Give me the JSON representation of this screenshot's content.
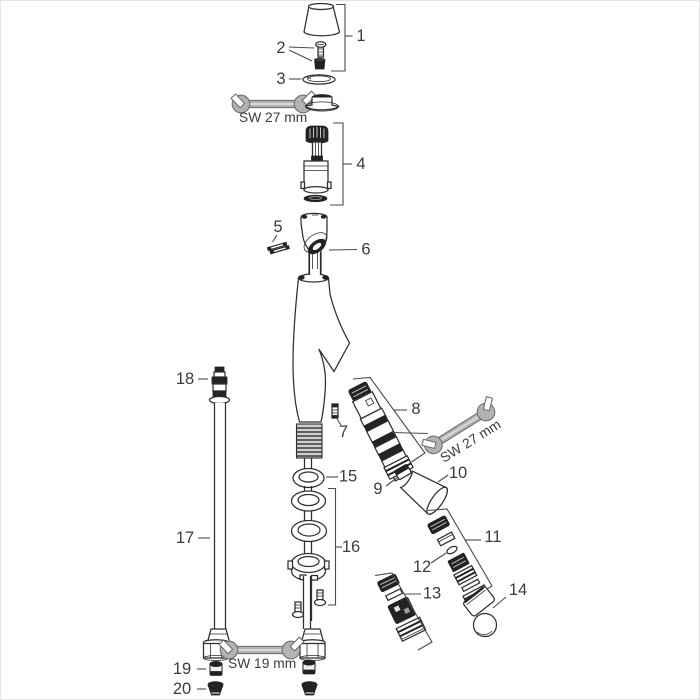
{
  "diagram": {
    "type": "exploded-parts-diagram",
    "subject": "single-lever-basin-mixer-faucet",
    "background": "#ffffff",
    "line_color": "#2f2f2f",
    "label_color": "#3c3c3c",
    "tool_color": "#b3b3b3",
    "callouts": [
      {
        "id": "1",
        "label": "1"
      },
      {
        "id": "2",
        "label": "2"
      },
      {
        "id": "3",
        "label": "3"
      },
      {
        "id": "4",
        "label": "4"
      },
      {
        "id": "5",
        "label": "5"
      },
      {
        "id": "6",
        "label": "6"
      },
      {
        "id": "7",
        "label": "7"
      },
      {
        "id": "8",
        "label": "8"
      },
      {
        "id": "9",
        "label": "9"
      },
      {
        "id": "10",
        "label": "10"
      },
      {
        "id": "11",
        "label": "11"
      },
      {
        "id": "12",
        "label": "12"
      },
      {
        "id": "13",
        "label": "13"
      },
      {
        "id": "14",
        "label": "14"
      },
      {
        "id": "15",
        "label": "15"
      },
      {
        "id": "16",
        "label": "16"
      },
      {
        "id": "17",
        "label": "17"
      },
      {
        "id": "18",
        "label": "18"
      },
      {
        "id": "19",
        "label": "19"
      },
      {
        "id": "20",
        "label": "20"
      }
    ],
    "tools": [
      {
        "id": "wrench-top",
        "label": "SW 27 mm"
      },
      {
        "id": "wrench-right",
        "label": "SW 27 mm"
      },
      {
        "id": "wrench-bottom",
        "label": "SW 19 mm"
      }
    ]
  }
}
